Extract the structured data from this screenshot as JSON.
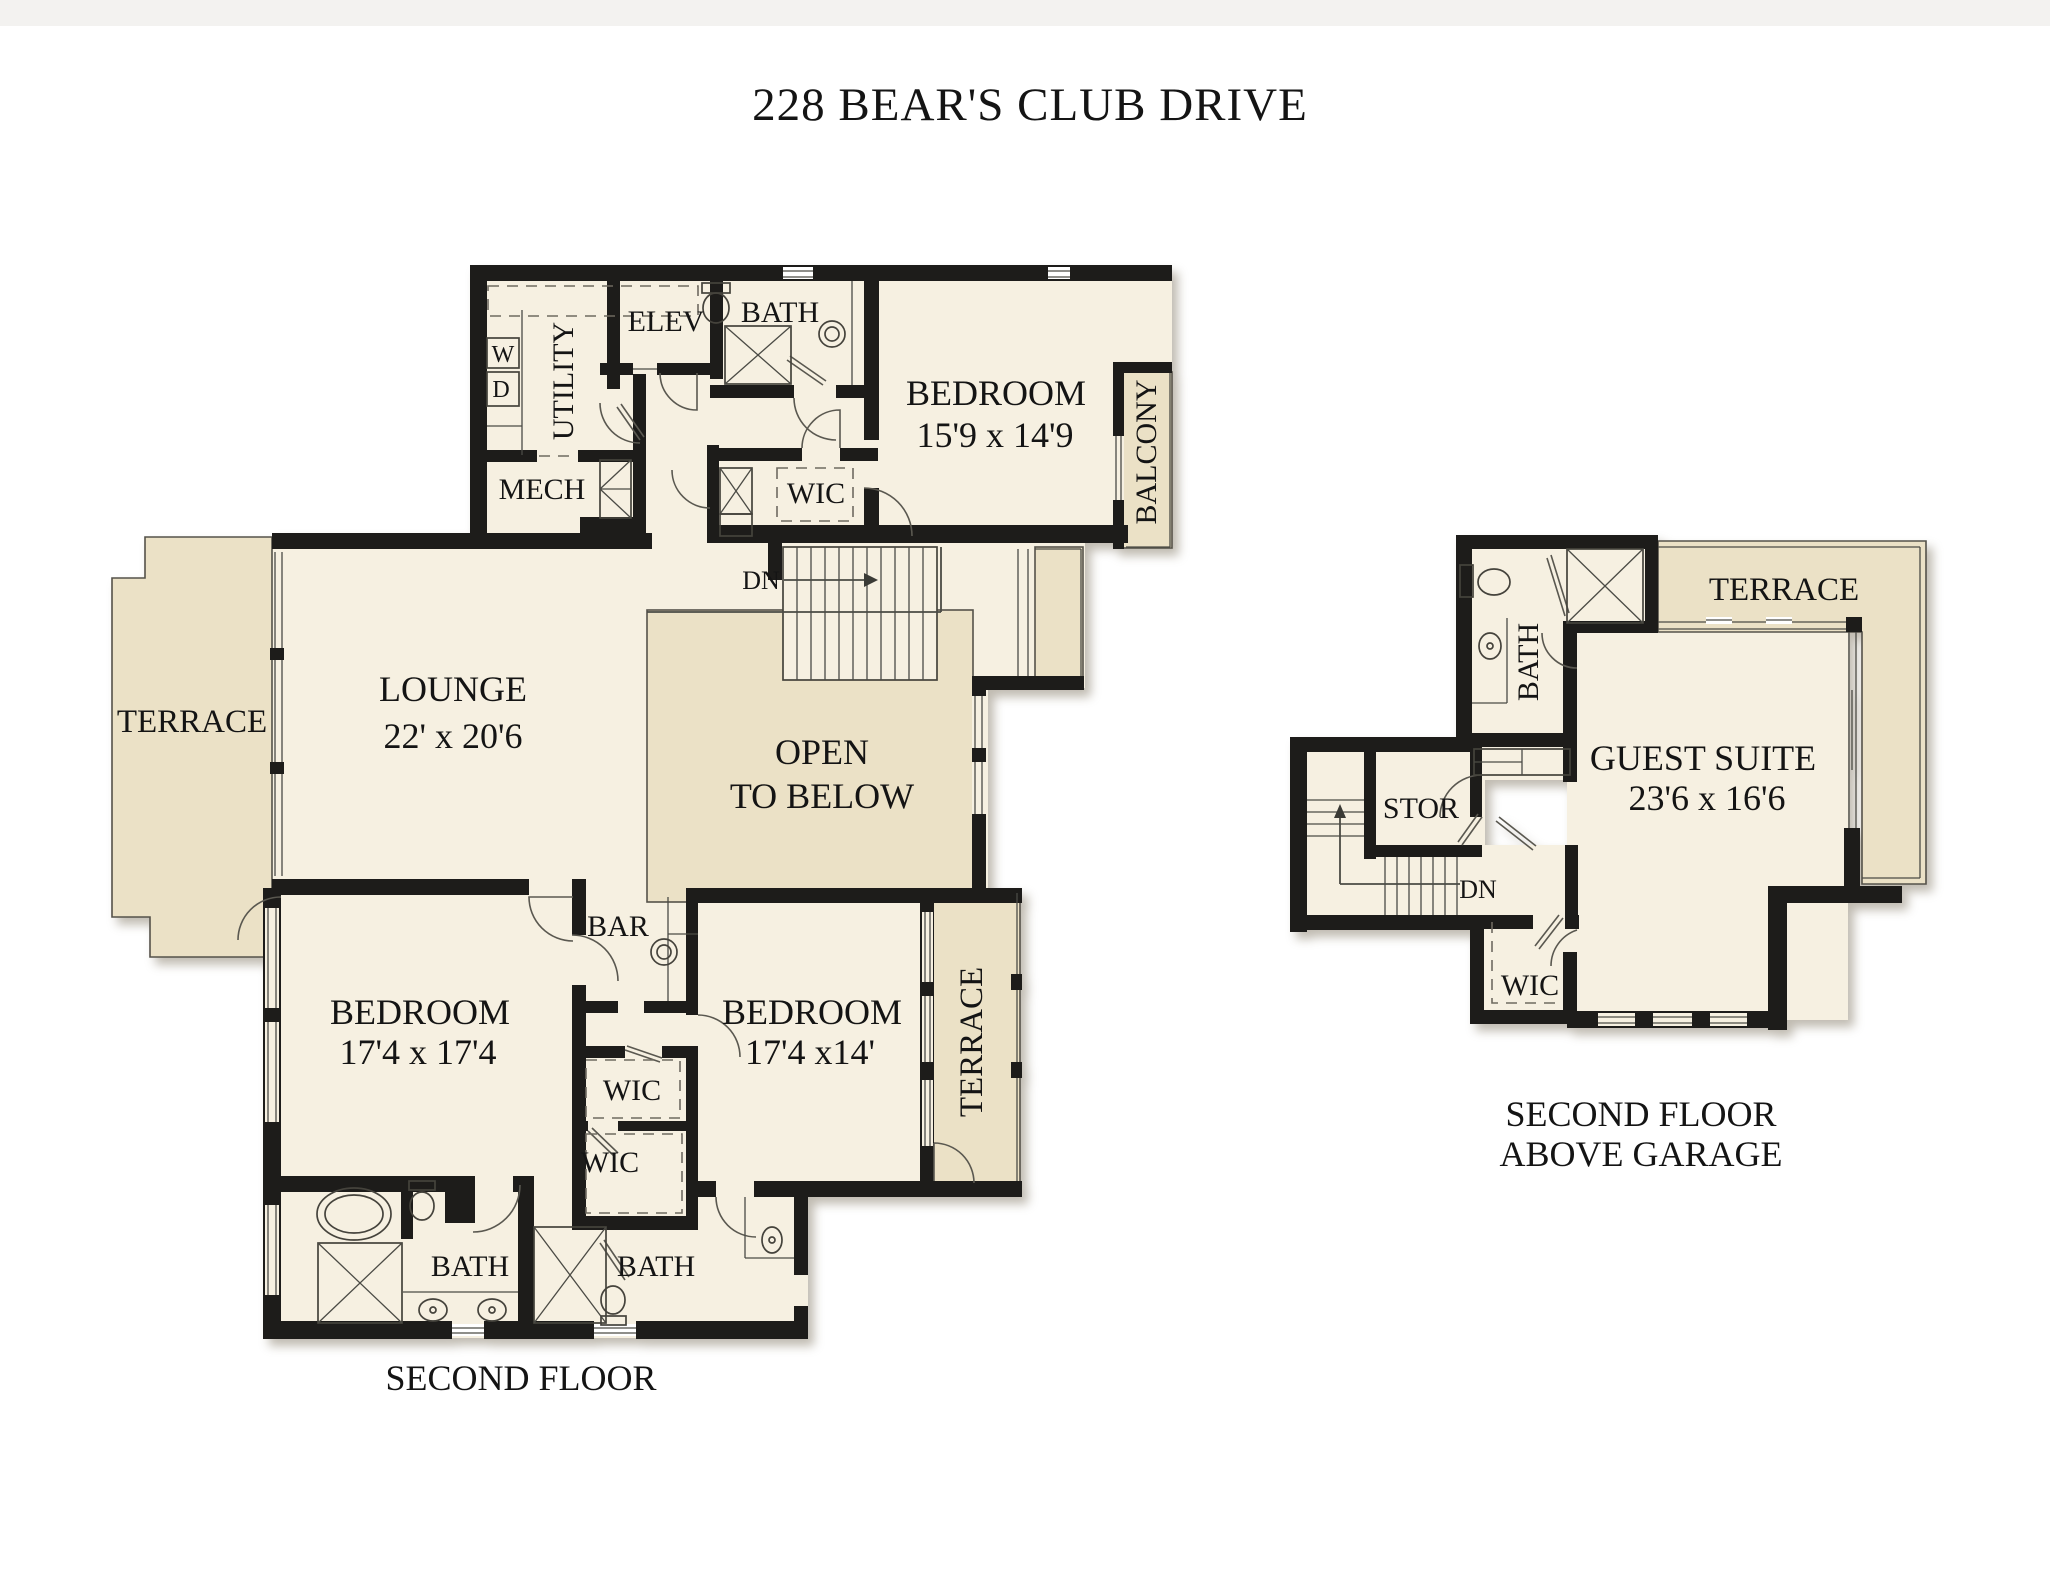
{
  "title": "228 BEAR'S CLUB DRIVE",
  "colors": {
    "paper": "#ffffff",
    "band": "#f3f2f0",
    "cream": "#f6f0e1",
    "tan": "#ebe1c6",
    "wall": "#1d1c1a",
    "line": "#4b4b45",
    "ink": "#141414"
  },
  "labels": {
    "main": {
      "caption": "SECOND FLOOR",
      "lounge": "LOUNGE",
      "lounge_dim": "22' x 20'6",
      "terrace_left": "TERRACE",
      "open_below_1": "OPEN",
      "open_below_2": "TO BELOW",
      "bedroom_master": "BEDROOM",
      "bedroom_master_dim": "15'9 x 14'9",
      "balcony": "BALCONY",
      "bath_top": "BATH",
      "elev": "ELEV",
      "utility": "UTILITY",
      "washer": "W",
      "dryer": "D",
      "mech": "MECH",
      "wic_top": "WIC",
      "dn": "DN",
      "bar": "BAR",
      "bedroom1": "BEDROOM",
      "bedroom1_dim": "17'4 x 17'4",
      "bedroom2": "BEDROOM",
      "bedroom2_dim": "17'4 x14'",
      "wic1": "WIC",
      "wic2": "WIC",
      "terrace_right": "TERRACE",
      "bath1": "BATH",
      "bath2": "BATH"
    },
    "garage": {
      "caption1": "SECOND FLOOR",
      "caption2": "ABOVE GARAGE",
      "terrace": "TERRACE",
      "bath": "BATH",
      "guest_suite": "GUEST SUITE",
      "guest_suite_dim": "23'6 x 16'6",
      "stor": "STOR",
      "dn": "DN",
      "wic": "WIC"
    }
  }
}
